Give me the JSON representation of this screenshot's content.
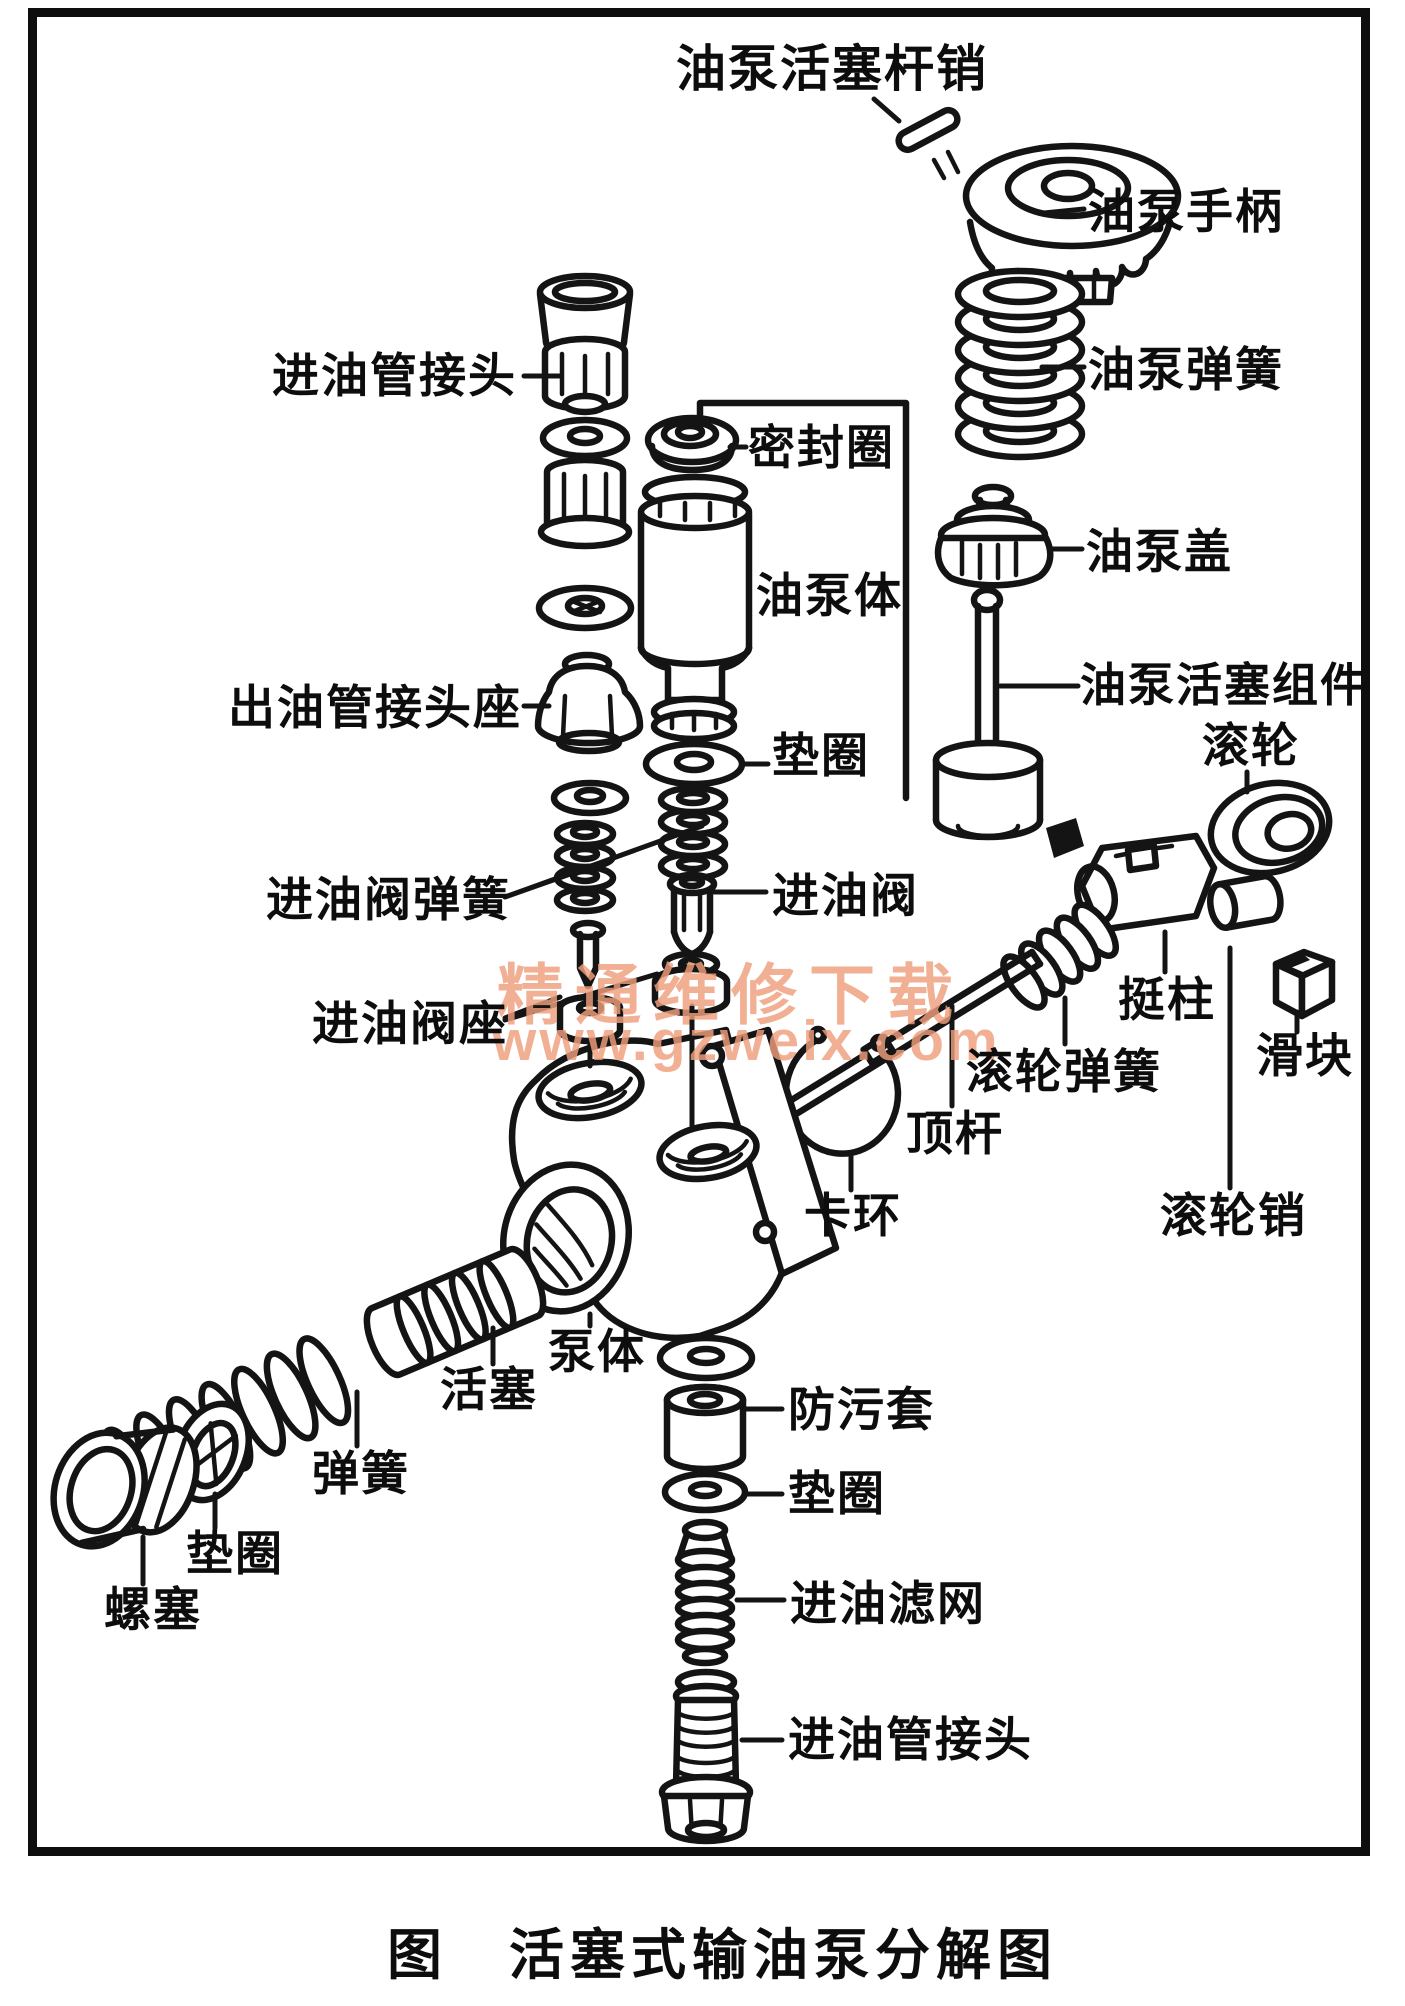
{
  "caption": "图　活塞式输油泵分解图",
  "watermark": {
    "line1": "精通维修下载",
    "line2": "www.gzweix.com",
    "color": "#ef9e7c"
  },
  "ink_color": "#141414",
  "labels": [
    {
      "id": "oil-pump-piston-rod-pin",
      "text": "油泵活塞杆销"
    },
    {
      "id": "oil-pump-handle",
      "text": "油泵手柄"
    },
    {
      "id": "oil-pump-spring",
      "text": "油泵弹簧"
    },
    {
      "id": "inlet-pipe-fitting-top",
      "text": "进油管接头"
    },
    {
      "id": "seal-ring",
      "text": "密封圈"
    },
    {
      "id": "oil-pump-barrel",
      "text": "油泵体"
    },
    {
      "id": "oil-pump-cover",
      "text": "油泵盖"
    },
    {
      "id": "oil-pump-piston-assembly",
      "text": "油泵活塞组件"
    },
    {
      "id": "roller",
      "text": "滚轮"
    },
    {
      "id": "outlet-pipe-fitting-seat",
      "text": "出油管接头座"
    },
    {
      "id": "washer-mid",
      "text": "垫圈"
    },
    {
      "id": "inlet-valve-spring",
      "text": "进油阀弹簧"
    },
    {
      "id": "inlet-valve",
      "text": "进油阀"
    },
    {
      "id": "inlet-valve-seat",
      "text": "进油阀座"
    },
    {
      "id": "tappet",
      "text": "挺柱"
    },
    {
      "id": "slider",
      "text": "滑块"
    },
    {
      "id": "roller-spring",
      "text": "滚轮弹簧"
    },
    {
      "id": "push-rod",
      "text": "顶杆"
    },
    {
      "id": "roller-pin",
      "text": "滚轮销"
    },
    {
      "id": "snap-ring",
      "text": "卡环"
    },
    {
      "id": "pump-body",
      "text": "泵体"
    },
    {
      "id": "piston",
      "text": "活塞"
    },
    {
      "id": "spring",
      "text": "弹簧"
    },
    {
      "id": "washer-left",
      "text": "垫圈"
    },
    {
      "id": "screw-plug",
      "text": "螺塞"
    },
    {
      "id": "dust-cover",
      "text": "防污套"
    },
    {
      "id": "washer-bottom",
      "text": "垫圈"
    },
    {
      "id": "inlet-filter",
      "text": "进油滤网"
    },
    {
      "id": "inlet-pipe-fitting-bottom",
      "text": "进油管接头"
    }
  ]
}
